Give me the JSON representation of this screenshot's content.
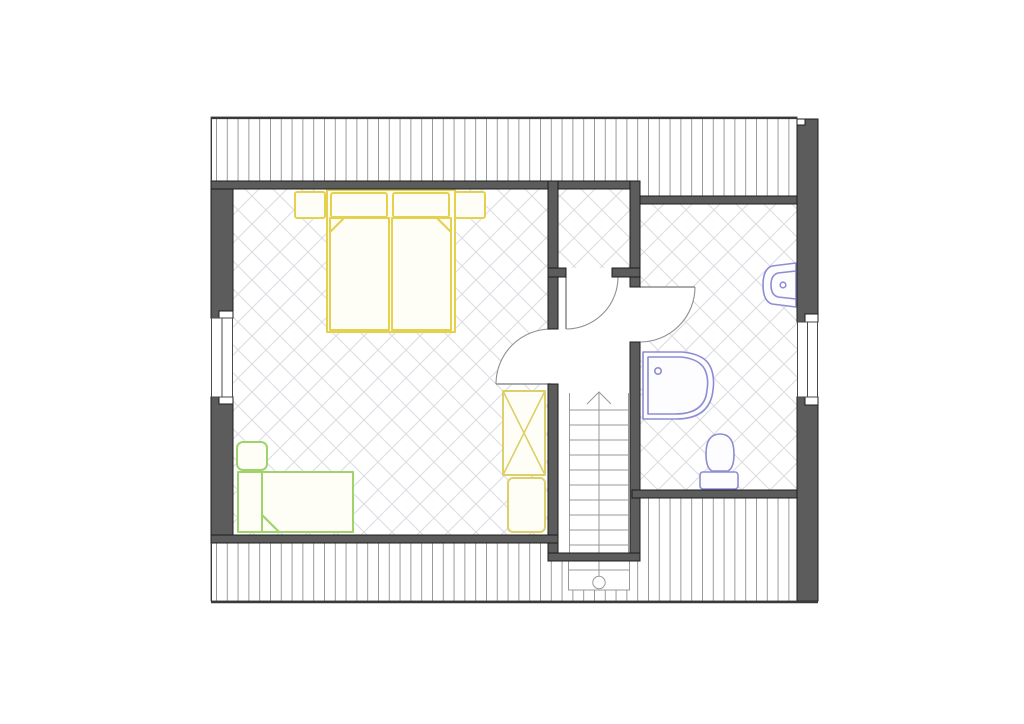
{
  "document": {
    "kind": "architectural-floor-plan",
    "visible_text": [],
    "notes": "black-and-white plan drawing with colored furniture symbols, roof-slope areas hatched with vertical lines, tiled rooms hatched with diagonal diamond grid"
  },
  "colors": {
    "paper": "#ffffff",
    "wall-fill": "#5c5c5c",
    "wall-outline": "#1d1d1d",
    "boundary-line": "#3a3a3a",
    "roof-hatch-line": "#909090",
    "floor-tile-line": "#dcdce4",
    "stair-line": "#9a9a9a",
    "door-line": "#8f8f8f",
    "window-frame": "#4a4a4a",
    "double-bed": "#e4d24e",
    "single-bed": "#9fd36b",
    "wardrobe": "#ddd06a",
    "sanitary": "#8d8dd2",
    "furniture-fill": "#fffef6"
  },
  "rooms": [
    {
      "name": "bedroom",
      "position": "left",
      "floor": "diamond-tile"
    },
    {
      "name": "closet",
      "position": "top-middle",
      "floor": "diamond-tile"
    },
    {
      "name": "hallway-stairwell",
      "position": "middle",
      "floor": "plain"
    },
    {
      "name": "bathroom",
      "position": "right",
      "floor": "diamond-tile"
    }
  ],
  "furniture": [
    {
      "name": "double-bed",
      "room": "bedroom",
      "color_key": "double-bed",
      "parts": [
        "two pillows",
        "two mattresses with folded corners",
        "left nightstand",
        "right nightstand"
      ]
    },
    {
      "name": "single-bed",
      "room": "bedroom",
      "color_key": "single-bed",
      "parts": [
        "pillow",
        "blanket with folded corner"
      ]
    },
    {
      "name": "wardrobe",
      "room": "bedroom",
      "color_key": "wardrobe",
      "symbol": "rectangle with X"
    },
    {
      "name": "cabinet",
      "room": "bedroom",
      "color_key": "wardrobe",
      "symbol": "rounded rectangle"
    }
  ],
  "fixtures": [
    {
      "name": "corner-shower",
      "room": "bathroom",
      "color_key": "sanitary"
    },
    {
      "name": "washbasin",
      "room": "bathroom",
      "color_key": "sanitary"
    },
    {
      "name": "toilet",
      "room": "bathroom",
      "color_key": "sanitary"
    }
  ],
  "doors": [
    {
      "name": "bedroom-door",
      "swing": "into bedroom"
    },
    {
      "name": "closet-door",
      "swing": "into hallway"
    },
    {
      "name": "bathroom-door",
      "swing": "into bathroom"
    }
  ],
  "windows": [
    {
      "name": "window-left",
      "wall": "left"
    },
    {
      "name": "window-right",
      "wall": "right"
    }
  ],
  "stairs": {
    "location": "hallway",
    "direction_marker": "arrow pointing up",
    "start_marker": "circle post",
    "treads": 12
  },
  "roof_hatch_areas": [
    {
      "name": "roof-slope-top",
      "hatch": "vertical-lines"
    },
    {
      "name": "roof-slope-bottom",
      "hatch": "vertical-lines"
    }
  ]
}
